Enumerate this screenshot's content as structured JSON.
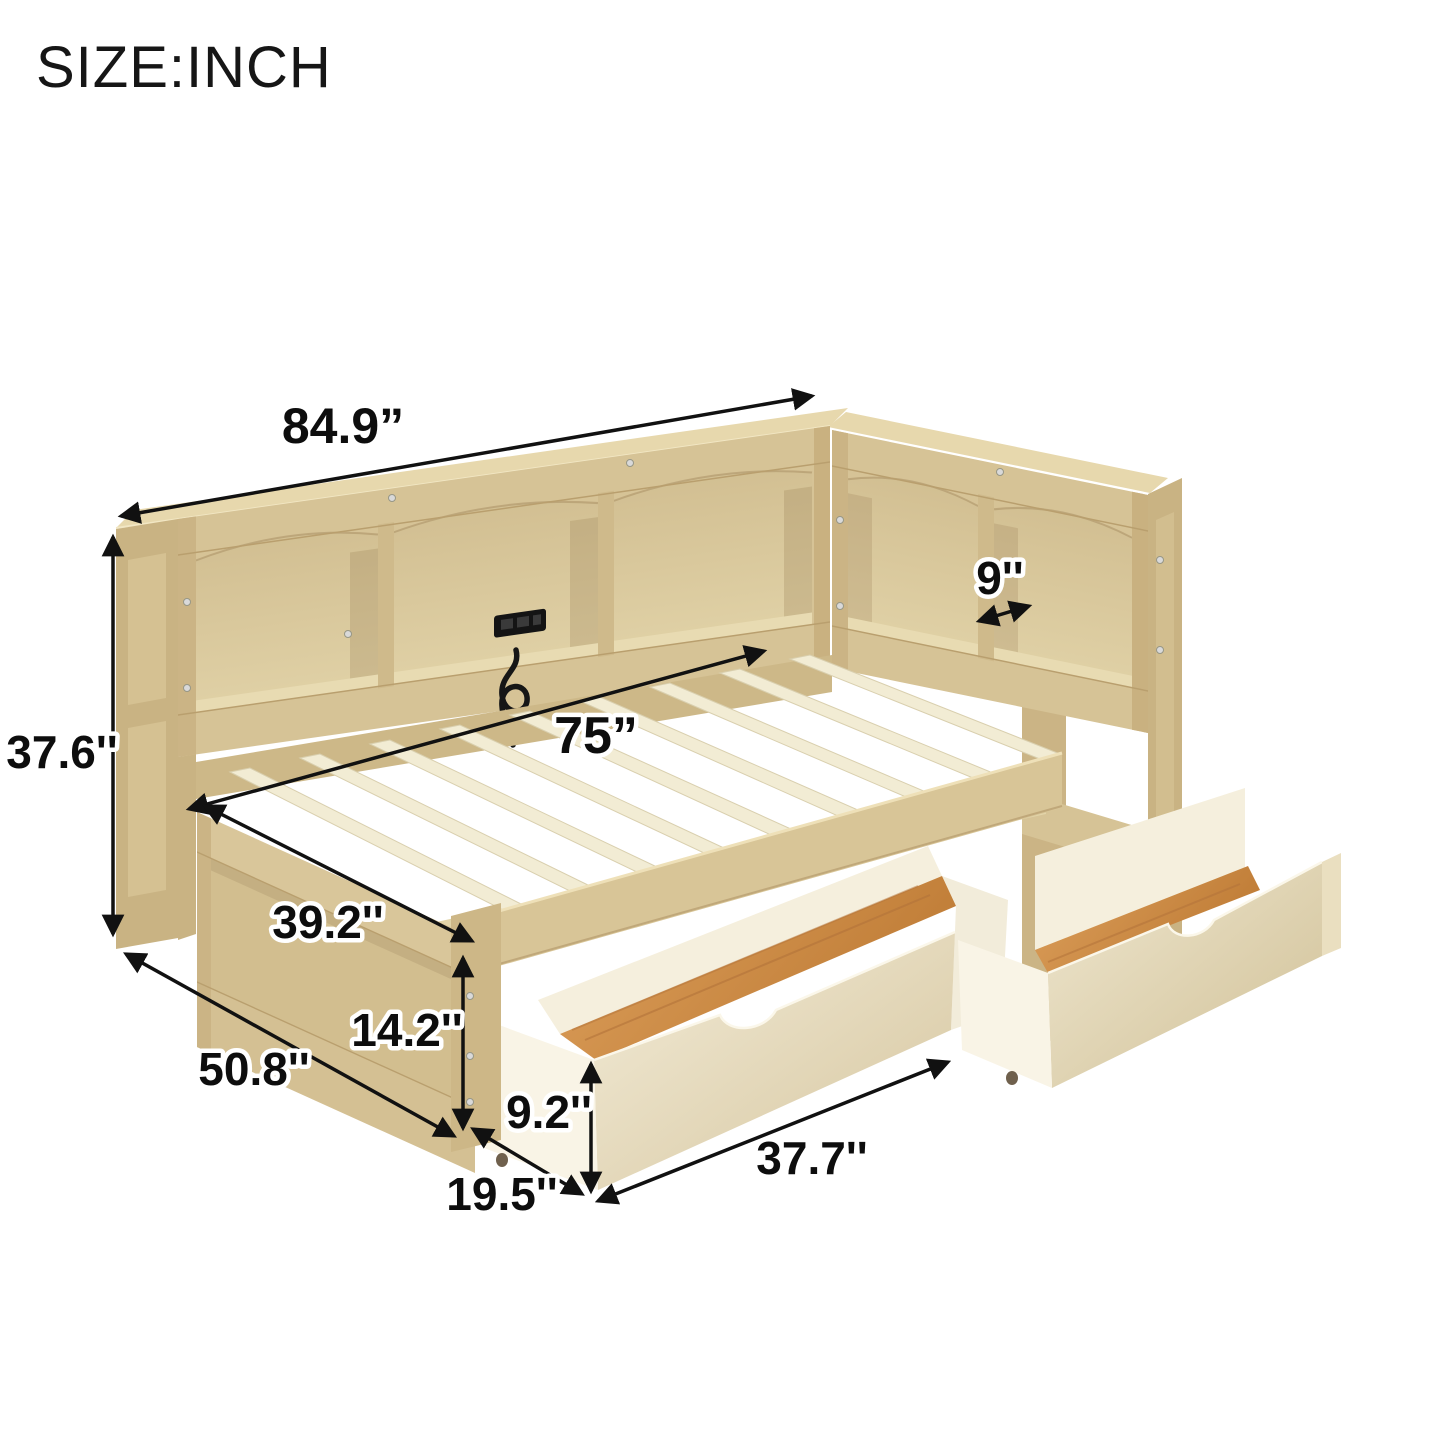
{
  "page": {
    "title": "SIZE:INCH",
    "background": "#ffffff"
  },
  "diagram": {
    "type": "furniture-dimension-diagram",
    "unit": "INCH",
    "parts": [
      "side-bookcase-headboard",
      "corner-bookcase",
      "bed-frame-with-slats",
      "footboard",
      "storage-drawer-left",
      "storage-drawer-right",
      "usb-charging-outlet",
      "power-cord"
    ],
    "dimensions": {
      "overall_length": {
        "label": "84.9”"
      },
      "shelf_depth": {
        "label": "9''"
      },
      "bookcase_height": {
        "label": "37.6''"
      },
      "slat_length": {
        "label": "75”"
      },
      "bed_width": {
        "label": "39.2''"
      },
      "frame_height": {
        "label": "14.2''"
      },
      "overall_depth": {
        "label": "50.8''"
      },
      "drawer_height": {
        "label": "9.2''"
      },
      "drawer_depth": {
        "label": "19.5''"
      },
      "drawer_length": {
        "label": "37.7''"
      }
    },
    "colors": {
      "wood_top": "#e7d8ad",
      "wood_front": "#d6c396",
      "wood_dark": "#c8b282",
      "cubby_back": "#dbca9f",
      "slat": "#f2ecd4",
      "drawer_white": "#f8f3e4",
      "drawer_face": "#e6d9ba",
      "drawer_bottom_wood": "#cf8f47",
      "annotation": "#111111"
    }
  }
}
